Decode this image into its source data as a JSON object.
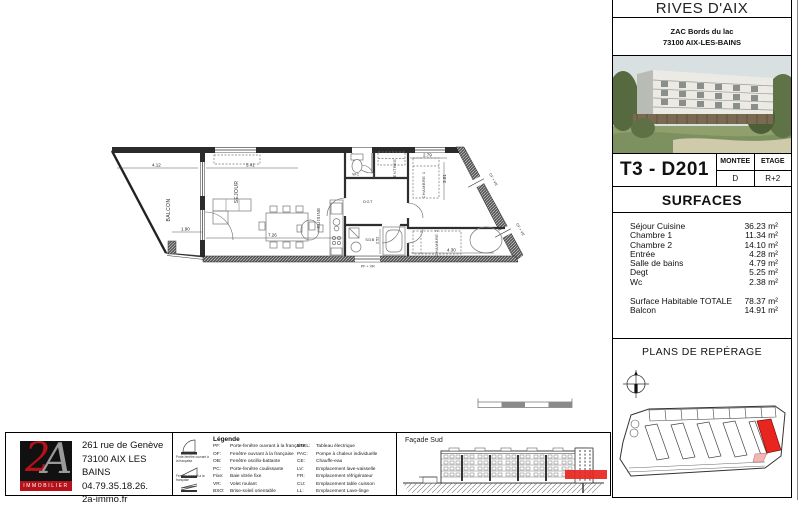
{
  "project": {
    "name": "RIVES D'AIX",
    "address_line1": "ZAC Bords du lac",
    "address_line2": "73100 AIX-LES-BAINS"
  },
  "unit": {
    "ref": "T3 - D201",
    "montee_label": "MONTEE",
    "montee_value": "D",
    "etage_label": "ETAGE",
    "etage_value": "R+2"
  },
  "surfaces": {
    "title": "SURFACES",
    "rows": [
      {
        "label": "Séjour Cuisine",
        "value": "36.23 m²"
      },
      {
        "label": "Chambre 1",
        "value": "11.34 m²"
      },
      {
        "label": "Chambre 2",
        "value": "14.10 m²"
      },
      {
        "label": "Entrée",
        "value": "4.28 m²"
      },
      {
        "label": "Salle de bains",
        "value": "4.79 m²"
      },
      {
        "label": "Degt",
        "value": "5.25 m²"
      },
      {
        "label": "Wc",
        "value": "2.38 m²"
      }
    ],
    "totals": [
      {
        "label": "Surface Habitable  TOTALE",
        "value": "78.37 m²"
      },
      {
        "label": "Balcon",
        "value": "14.91 m²"
      }
    ]
  },
  "reperage": {
    "title": "PLANS DE REPÉRAGE"
  },
  "facade": {
    "title": "Façade Sud"
  },
  "agency": {
    "logo_text": "2",
    "logo_text2": "A",
    "logo_sub": "IMMOBILIER",
    "line1": "261 rue de Genève",
    "line2": "73100 AIX LES BAINS",
    "line3": "04.79.35.18.26.",
    "line4": "2a-immo.fr"
  },
  "legend": {
    "title": "Légende",
    "col1": [
      {
        "abbr": "PF:",
        "desc": "Porte-fenêtre ouvrant à la française"
      },
      {
        "abbr": "OF:",
        "desc": "Fenêtre ouvrant à la française"
      },
      {
        "abbr": "OB:",
        "desc": "Fenêtre oscillo-battante"
      },
      {
        "abbr": "PC:",
        "desc": "Porte-fenêtre coulissante"
      },
      {
        "abbr": "Fixe:",
        "desc": "Baie vitrée fixe"
      },
      {
        "abbr": "VR:",
        "desc": "Volet roulant"
      },
      {
        "abbr": "BSO:",
        "desc": "Brise-soleil orientable"
      }
    ],
    "col2": [
      {
        "abbr": "ETEL:",
        "desc": "Tableau électrique"
      },
      {
        "abbr": "PAC:",
        "desc": "Pompe à chaleur individuelle"
      },
      {
        "abbr": "CE:",
        "desc": "Chauffe-eau"
      },
      {
        "abbr": "LV:",
        "desc": "Emplacement lave-vaisselle"
      },
      {
        "abbr": "FR:",
        "desc": "Emplacement réfrigérateur"
      },
      {
        "abbr": "CU:",
        "desc": "Emplacement table cuisson"
      },
      {
        "abbr": "LL:",
        "desc": "Emplacement Lave-linge"
      }
    ],
    "icon1_caption": "Porte-fenêtre ouvrant à la française",
    "icon2_caption": "Fenêtre ouvrant à la française"
  },
  "plan": {
    "rooms": {
      "balcon": "BALCON",
      "sejour": "SEJOUR",
      "cuisine": "CUISINE",
      "entree": "ENTREE",
      "wc": "WC",
      "sdb": "SDB",
      "dgt": "DGT",
      "chambre1": "CHAMBRE 1",
      "chambre2": "CHAMBRE 2"
    },
    "dims": {
      "d_balcon_l": "4.12",
      "d_sejour_top": "5.41",
      "d_balcon_w": "1.90",
      "d_sejour_w": "7.26",
      "d_ch1_w": "2.79",
      "d_ch1_h": "3.01",
      "d_sdb": "2.52",
      "d_ch2_w": "4.30"
    },
    "windows": {
      "w1": "CF + VR",
      "w2": "CF + VR",
      "w3": "PF + VR"
    }
  },
  "colors": {
    "highlight_red": "#e8251f",
    "logo_red": "#b5121b",
    "wall_dark": "#2b2b2b"
  }
}
